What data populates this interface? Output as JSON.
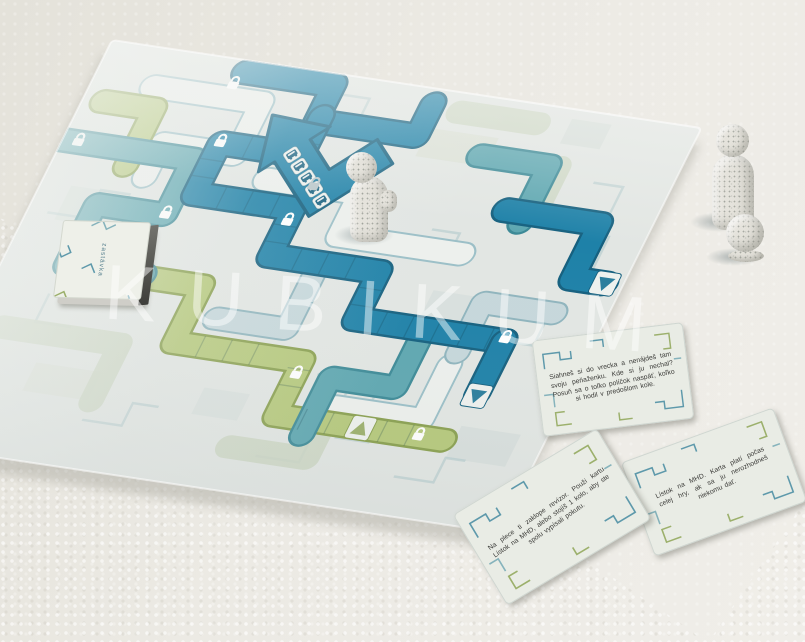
{
  "photo": {
    "watermark": "KUBIKUM"
  },
  "board_game": {
    "deck_label": "zastávka",
    "cards": [
      {
        "text": "Siahneš si do vrecka a nenájdeš tam svoju peňaženku. Kde si ju nechal? Posuň sa o toľko políčok naspäť, koľko si hodil v predošlom kole."
      },
      {
        "text": "Lístok na MHD. Karta platí počas celej hry, ak sa ju nerozhodneš niekomu dať."
      },
      {
        "text": "Na plece ti zaklope revízor. Použi kartu Lístok na MHD, alebo stojíš 1 kolo, aby ste spolu vypísali pokutu."
      }
    ],
    "palette": {
      "board_dark_teal": "#1e81a8",
      "board_mid_teal": "#5ea7b1",
      "board_pale_blue": "#c6d7db",
      "board_green": "#b6c97c",
      "board_base": "#e2e6e3",
      "surface": "#eae9e3",
      "piece_color": "#e5e3dc"
    }
  }
}
